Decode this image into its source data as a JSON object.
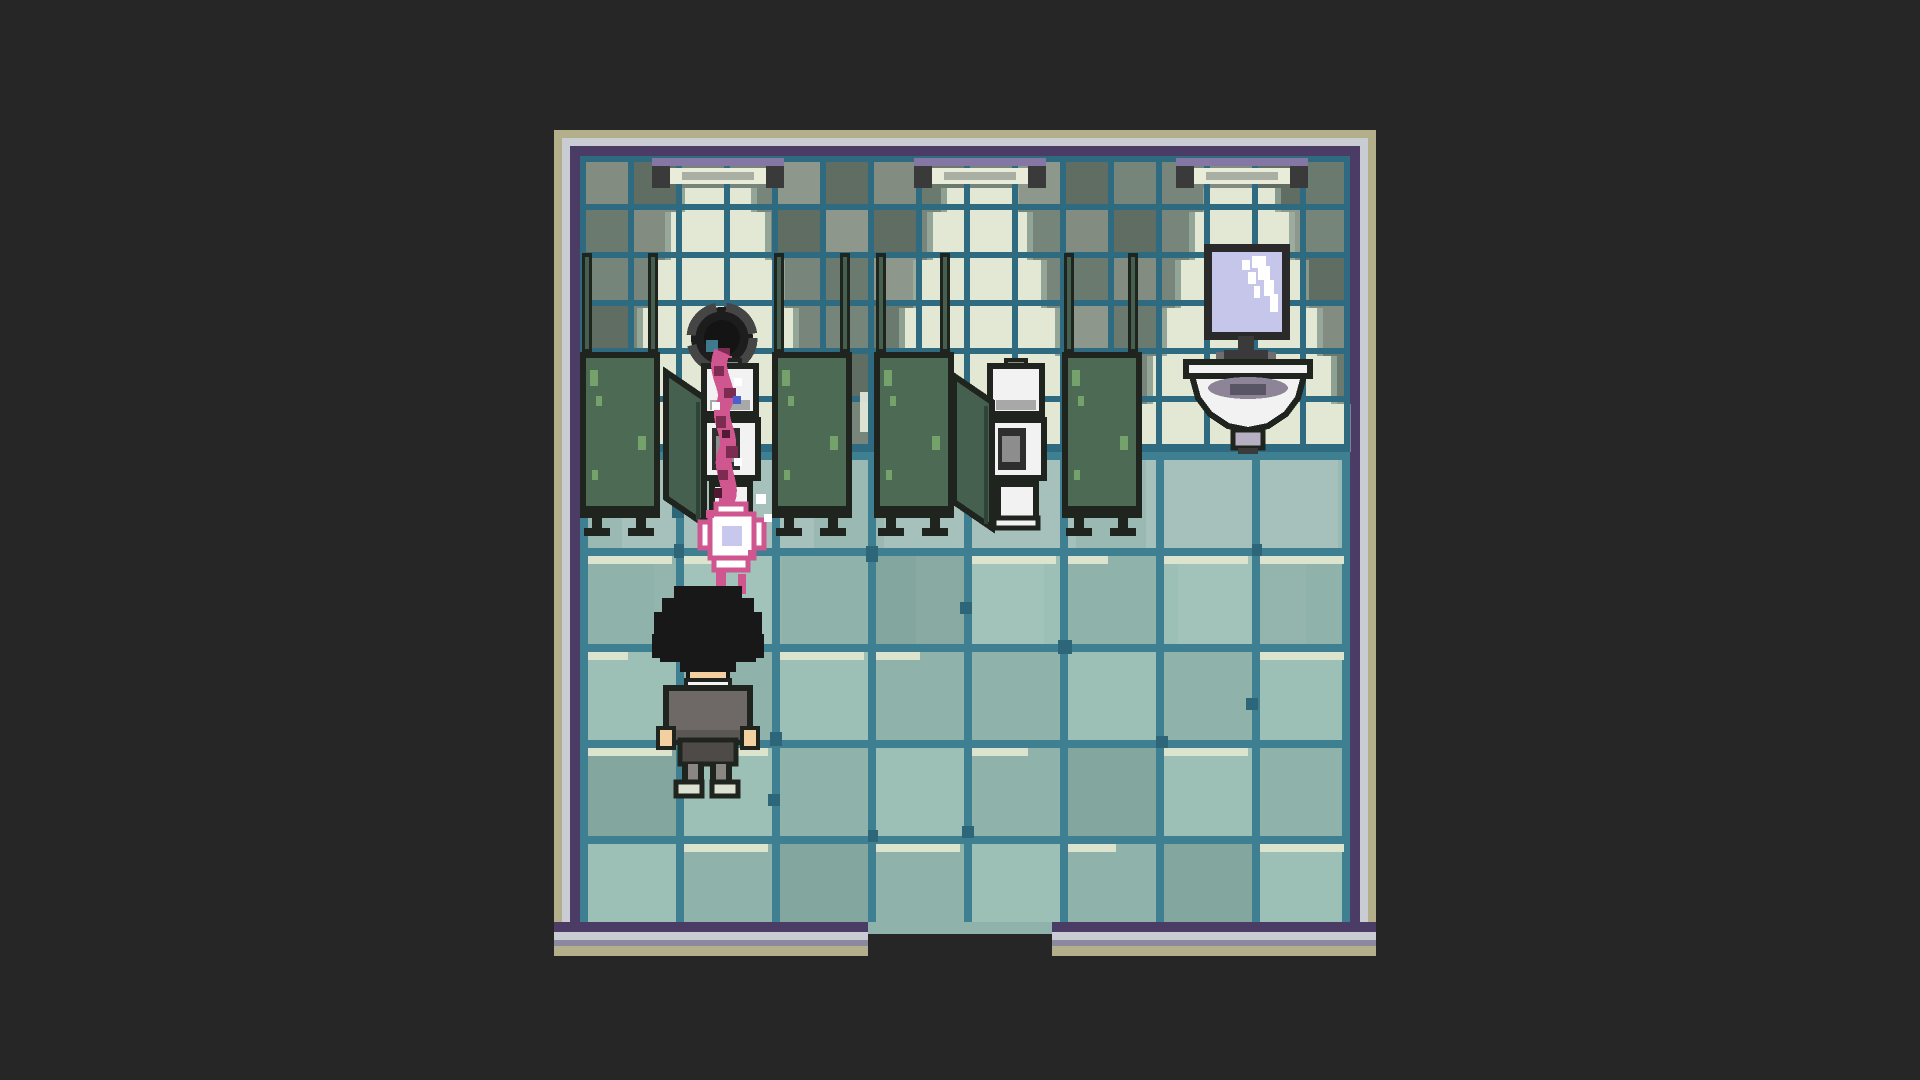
{
  "scene": {
    "name": "pixel-art bathroom room with stalls, sink and tentacle vortex",
    "room": {
      "outer": {
        "x": 554,
        "y": 130,
        "w": 822,
        "h": 826
      },
      "inner": {
        "x": 580,
        "y": 156,
        "w": 770,
        "h": 766
      },
      "wall_height": 296,
      "door_gap": {
        "x": 868,
        "w": 184
      }
    },
    "floor": {
      "tile_size": 96,
      "cols": 8,
      "rows": 5
    },
    "wall_tile_size": 48,
    "entities": {
      "lights": [
        {
          "x": 652,
          "y": 158
        },
        {
          "x": 914,
          "y": 158
        },
        {
          "x": 1176,
          "y": 158
        }
      ],
      "poles": [
        {
          "x": 582,
          "y": 253
        },
        {
          "x": 648,
          "y": 253
        },
        {
          "x": 774,
          "y": 253
        },
        {
          "x": 840,
          "y": 253
        },
        {
          "x": 876,
          "y": 253
        },
        {
          "x": 940,
          "y": 253
        },
        {
          "x": 1064,
          "y": 253
        },
        {
          "x": 1128,
          "y": 253
        }
      ],
      "partitions": [
        {
          "x": 580,
          "y": 352
        },
        {
          "x": 772,
          "y": 352
        },
        {
          "x": 874,
          "y": 352
        },
        {
          "x": 1062,
          "y": 352
        }
      ],
      "doors": [
        {
          "x": 666,
          "y": 372
        },
        {
          "x": 954,
          "y": 376
        }
      ],
      "toilets": [
        {
          "x": 694,
          "y": 360
        },
        {
          "x": 980,
          "y": 360
        }
      ],
      "spiral": {
        "x": 686,
        "y": 300
      },
      "flower": {
        "x": 700,
        "y": 504
      },
      "mirror": {
        "x": 1208,
        "y": 248
      },
      "sink": {
        "x": 1186,
        "y": 336
      },
      "character": {
        "x": 652,
        "y": 584
      }
    }
  },
  "palette": {
    "bg": "#262626",
    "frame_tan": "#b2af8a",
    "frame_light": "#c9ccd2",
    "frame_mid": "#8a89a0",
    "frame_purple": "#4a3c64",
    "wall_base": "#77857b",
    "wall_grout": "#2e6b80",
    "cone": "#e2e8d3",
    "cone_soft": "#aabfae",
    "floor_base": "#8fb2aa",
    "floor_light": "#9dc0b6",
    "floor_dark": "#83a69f",
    "floor_grout": "#3f7f92",
    "floor_grout_dark": "#2d6678",
    "tile_highlight": "#dde4cd",
    "stall_green": "#4d6a55",
    "stall_door": "#45604e",
    "moss": "#7cab6f",
    "outline": "#20241f",
    "porcelain": "#f2f2f2",
    "porcelain_shadow": "#a8a8a8",
    "fixture_gray": "#8d8d8d",
    "seat_dark": "#2e2e2e",
    "fixture_dark": "#3a3a3a",
    "fixture_purple": "#8577a3",
    "fixture_tube": "#e9ecd9",
    "fixture_tube_mid": "#99a094",
    "mirror_glass": "#c6c6ea",
    "sink_inner": "#8d8498",
    "sink_slot": "#5a5564",
    "pedestal": "#b6b0c2",
    "tentacle_pink": "#cf568e",
    "tentacle_dark": "#7c2c51",
    "tentacle_deep": "#4f1b33",
    "flower_center": "#c8c8ee",
    "glint_blue": "#4a5fd0",
    "hair": "#181818",
    "skin": "#f4cf9f",
    "collar": "#f5f5f5",
    "sweater": "#6e6966",
    "sweater_shadow": "#5b5754",
    "pants": "#4e4a47",
    "leg_gray": "#8a8682",
    "shoes": "#dbe2d2"
  }
}
